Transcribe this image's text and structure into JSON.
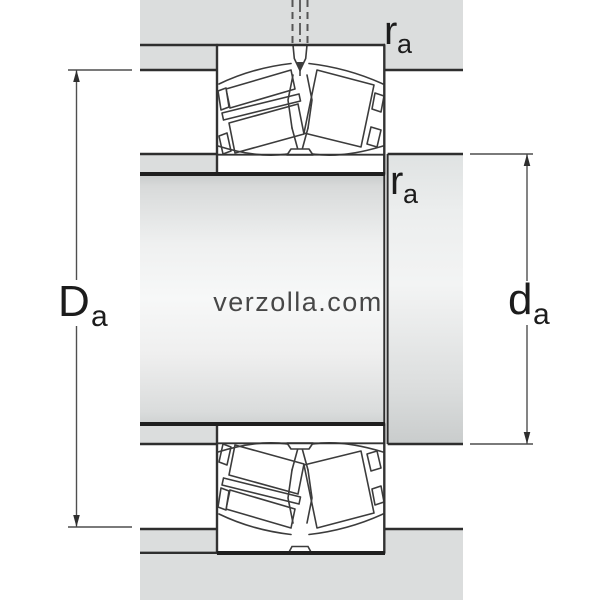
{
  "labels": {
    "housing_abutment_diameter": {
      "main": "D",
      "sub": "a"
    },
    "shaft_abutment_diameter": {
      "main": "d",
      "sub": "a"
    },
    "fillet_radius_top": {
      "main": "r",
      "sub": "a"
    },
    "fillet_radius_mid": {
      "main": "r",
      "sub": "a"
    }
  },
  "watermark": {
    "text": "verzolla.com"
  },
  "colors": {
    "abutment_fill": "#dbdddd",
    "outline": "#2e2e2e",
    "thick_line": "#1f1f1f",
    "dimension_line": "#4f4f4f",
    "watermark": "#ffffff"
  }
}
